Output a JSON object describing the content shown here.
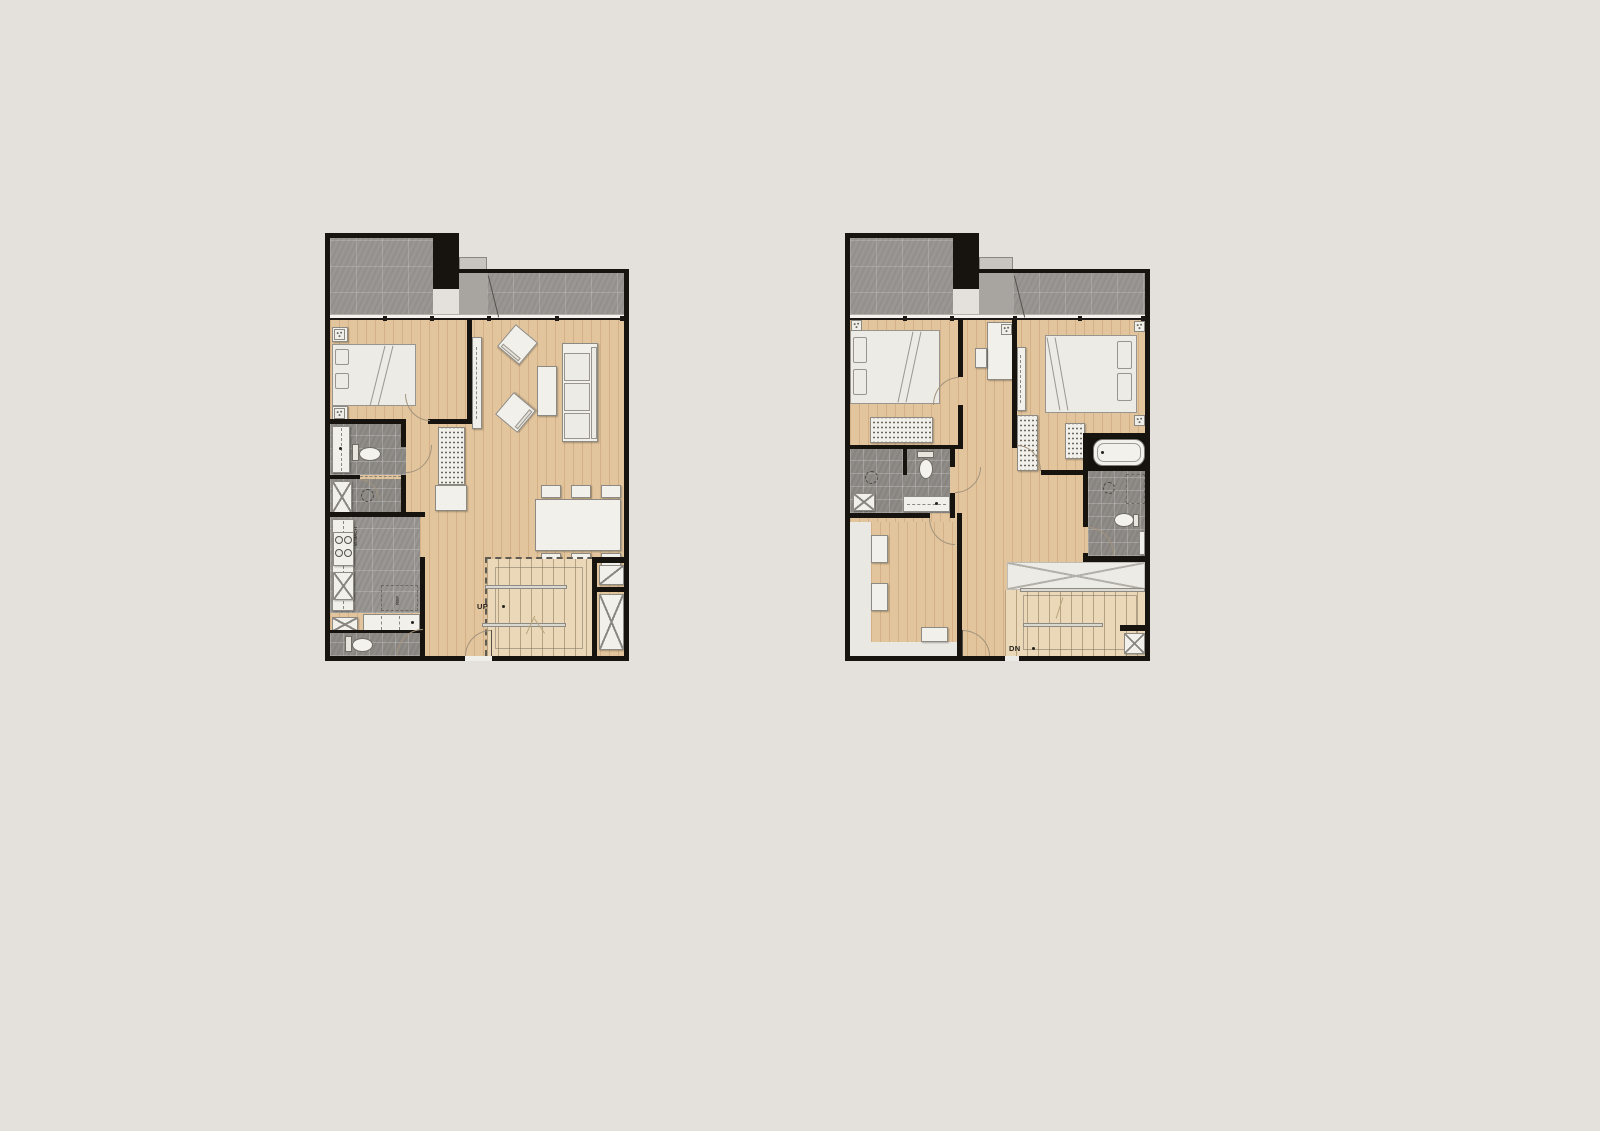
{
  "canvas": {
    "width": 1600,
    "height": 1131,
    "background": "#e4e1dc"
  },
  "plans": {
    "lower": {
      "labels": {
        "stairs": "UP",
        "washing_machine": "W.MACH",
        "refrigerator": "REF"
      }
    },
    "upper": {
      "labels": {
        "stairs": "DN"
      }
    }
  },
  "colors": {
    "wall": "#17130f",
    "wood_floor": "#e3c59d",
    "stair_wood": "#ead8b8",
    "balcony_tile": "#9a9793",
    "bathroom_tile": "#8f8c88",
    "kitchen_tile": "#999693",
    "entry_vestibule": "#a8a5a1",
    "furniture": "#f2f0ea",
    "closet_floor": "#eae8e3"
  }
}
